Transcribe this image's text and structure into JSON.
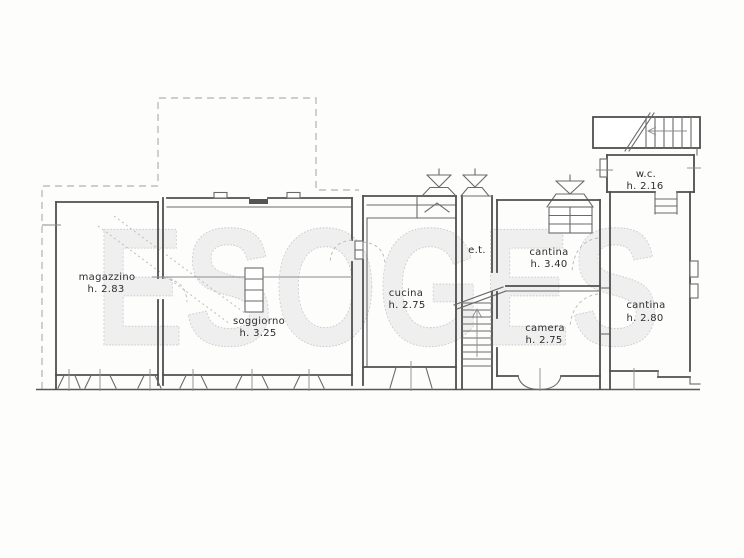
{
  "document": {
    "kind": "scanned floor plan drawing",
    "background": "#fdfdfc"
  },
  "watermark": {
    "text": "ESOGES",
    "fill": "#efefef",
    "outline": "#cccccc"
  },
  "plan": {
    "line_color": "#4f4f4f",
    "thin_line_color": "#6a6a6a",
    "dashed_outline_color": "#b3b3b3",
    "rooms": [
      {
        "name": "magazzino",
        "height": "h. 2.83"
      },
      {
        "name": "soggiorno",
        "height": "h. 3.25"
      },
      {
        "name": "cucina",
        "height": "h. 2.75"
      },
      {
        "name": "e.t.",
        "height": ""
      },
      {
        "name": "cantina",
        "height": "h. 3.40"
      },
      {
        "name": "camera",
        "height": "h. 2.75"
      },
      {
        "name": "w.c.",
        "height": "h. 2.16"
      },
      {
        "name": "cantina",
        "height": "h. 2.80"
      }
    ]
  }
}
